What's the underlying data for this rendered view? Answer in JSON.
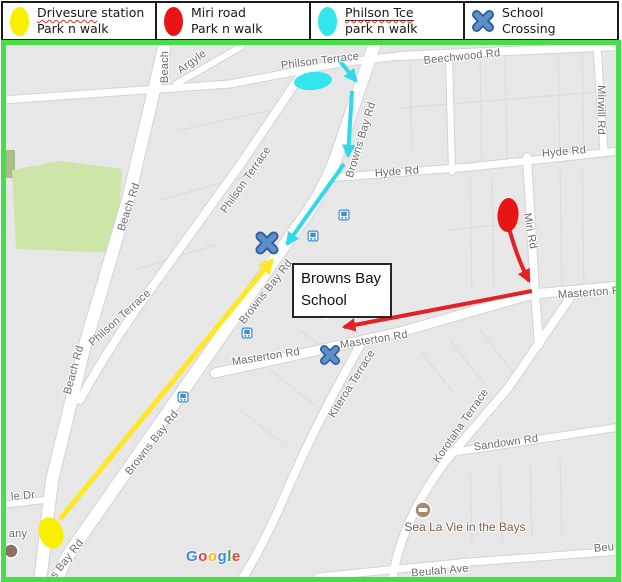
{
  "legend": {
    "items": [
      {
        "icon": "yellow-ellipse",
        "color": "#f9ef00",
        "term": "Drivesure",
        "rest": " station",
        "line2": "Park n walk"
      },
      {
        "icon": "red-ellipse",
        "color": "#e81416",
        "term": "",
        "rest": "Miri road",
        "line2": "Park n walk"
      },
      {
        "icon": "cyan-ellipse",
        "color": "#35e5ee",
        "term": "Philson Tce",
        "rest": "",
        "line2": "park n walk"
      },
      {
        "icon": "blue-x",
        "color": "#5d8fcc",
        "term": "",
        "rest": "School",
        "line2": "Crossing"
      }
    ]
  },
  "colors": {
    "frame_green": "#47df47",
    "drivesure_yellow": "#f9ef00",
    "miri_red": "#e81416",
    "philson_cyan": "#35e5ee",
    "crossing_blue": "#5d8fcc",
    "park_green": "#cde5a6"
  },
  "map": {
    "school_box": {
      "line1": "Browns Bay",
      "line2": "School"
    },
    "attribution": "Google",
    "google": [
      "G",
      "o",
      "o",
      "g",
      "l",
      "e"
    ],
    "streets": [
      {
        "label": "Beach",
        "x": 159,
        "y": 22,
        "rot": -90
      },
      {
        "label": "Argyle",
        "x": 186,
        "y": 17,
        "rot": -36
      },
      {
        "label": "Philson Terrace",
        "x": 314,
        "y": 16,
        "rot": -7
      },
      {
        "label": "Beechwood Rd",
        "x": 456,
        "y": 12,
        "rot": -6
      },
      {
        "label": "Mirwill Rd",
        "x": 595,
        "y": 65,
        "rot": 90
      },
      {
        "label": "Hyde Rd",
        "x": 558,
        "y": 107,
        "rot": -5
      },
      {
        "label": "Hyde Rd",
        "x": 391,
        "y": 127,
        "rot": -4
      },
      {
        "label": "Browns Bay Rd",
        "x": 355,
        "y": 95,
        "rot": -73
      },
      {
        "label": "Philson Terrace",
        "x": 240,
        "y": 135,
        "rot": -55
      },
      {
        "label": "Philson Terrace",
        "x": 114,
        "y": 273,
        "rot": -42
      },
      {
        "label": "Beach Rd",
        "x": 123,
        "y": 162,
        "rot": -72
      },
      {
        "label": "Beach Rd",
        "x": 68,
        "y": 325,
        "rot": -75
      },
      {
        "label": "Miri Rd",
        "x": 524,
        "y": 186,
        "rot": 80
      },
      {
        "label": "Masterton R",
        "x": 583,
        "y": 248,
        "rot": -4
      },
      {
        "label": "Masterton Rd",
        "x": 368,
        "y": 295,
        "rot": -9
      },
      {
        "label": "Masterton Rd",
        "x": 260,
        "y": 312,
        "rot": -9
      },
      {
        "label": "Kiteroa Terrace",
        "x": 346,
        "y": 339,
        "rot": -58
      },
      {
        "label": "Korotaha Terrace",
        "x": 455,
        "y": 381,
        "rot": -55
      },
      {
        "label": "Sandown Rd",
        "x": 500,
        "y": 398,
        "rot": -8
      },
      {
        "label": "Beulah Ave",
        "x": 434,
        "y": 526,
        "rot": -5
      },
      {
        "label": "Beu",
        "x": 598,
        "y": 503,
        "rot": -5
      },
      {
        "label": "le Dr",
        "x": 17,
        "y": 451,
        "rot": -5
      },
      {
        "label": "any",
        "x": 12,
        "y": 489,
        "rot": 0
      },
      {
        "label": "Browns Bay Rd",
        "x": 260,
        "y": 247,
        "rot": -52
      },
      {
        "label": "Browns Bay Rd",
        "x": 146,
        "y": 398,
        "rot": -52
      },
      {
        "label": "s Bay Rd",
        "x": 61,
        "y": 514,
        "rot": -52
      }
    ],
    "pois": [
      {
        "label": "Sea La Vie in the Bays",
        "x": 459,
        "y": 482,
        "rot": 0
      }
    ],
    "bus_stops": [
      {
        "x": 338,
        "y": 168
      },
      {
        "x": 307,
        "y": 189
      },
      {
        "x": 241,
        "y": 286
      },
      {
        "x": 177,
        "y": 350
      }
    ],
    "crossings": [
      {
        "x": 261,
        "y": 198,
        "size": 23
      },
      {
        "x": 324,
        "y": 310,
        "size": 20
      }
    ]
  }
}
